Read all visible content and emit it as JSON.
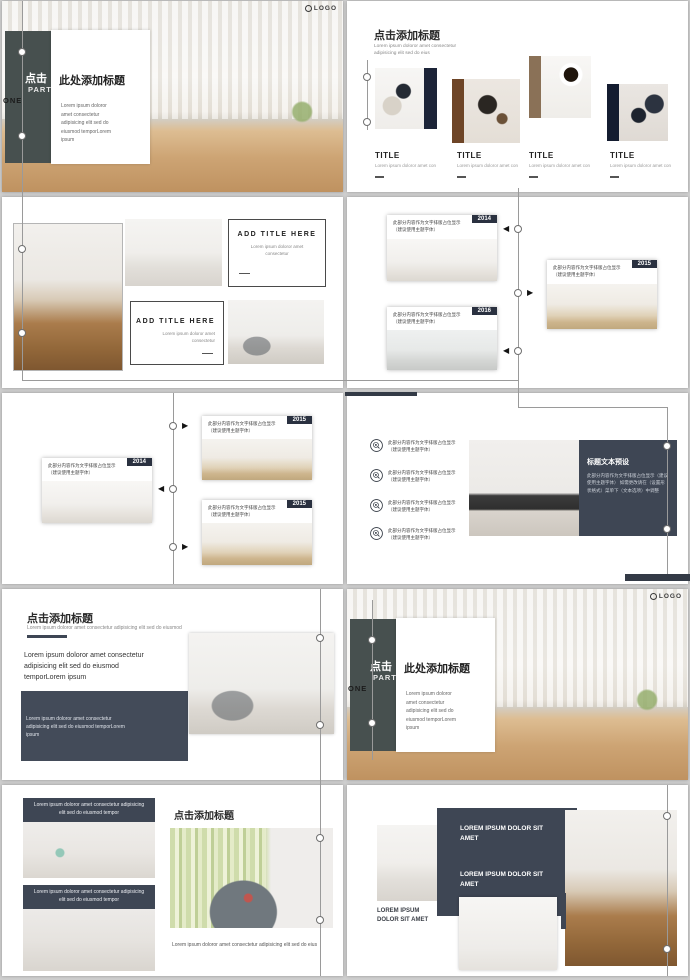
{
  "logo": {
    "text": "LOGO"
  },
  "colors": {
    "gap_background": "#cfcfcf",
    "accent_dark": "#3e4654",
    "cover_panel": "#47504f",
    "badge_navy": "#2a3140",
    "bar_navy": "#1c2438",
    "bar_brown": "#6e4527",
    "bar_tan": "#8a7157"
  },
  "cover": {
    "click": "点击",
    "part": "PART",
    "one": "ONE",
    "title": "此处添加标题",
    "body": "Lorem ipsum doloror amet consectetur adipisicing elit sed do eiusmod temporLorem ipsum"
  },
  "slide2": {
    "title": "点击添加标题",
    "subtitle": "Lorem ipsum doloror amet consectetur adipisicing elit sed do eius",
    "cards": [
      {
        "title": "TITLE",
        "desc": "Lorem ipsum doloror amet con"
      },
      {
        "title": "TITLE",
        "desc": "Lorem ipsum doloror amet con"
      },
      {
        "title": "TITLE",
        "desc": "Lorem ipsum doloror amet con"
      },
      {
        "title": "TITLE",
        "desc": "Lorem ipsum doloror amet con"
      }
    ]
  },
  "slide3": {
    "boxes": [
      {
        "title": "ADD TITLE HERE",
        "body": "Lorem ipsum doloror amet consectetur"
      },
      {
        "title": "ADD TITLE HERE",
        "body": "Lorem ipsum doloror amet consectetur"
      }
    ]
  },
  "timeline_placeholder": {
    "line1": "此部分内容作为文字排版占位显示",
    "line2": "（建议使用主题字体）"
  },
  "slide4": {
    "years": [
      "2014",
      "2016",
      "2015"
    ]
  },
  "slide5": {
    "years": [
      "2015",
      "2015",
      "2014"
    ]
  },
  "slide6": {
    "item_line1": "此部分内容作为文字排版占位显示",
    "item_line2": "（建议使用主题字体）",
    "panel_title": "标题文本预设",
    "panel_body": "此部分内容作为文字排版占位显示（建议使用主题字体） 如需更改请在（设置形状格式）菜单下（文本选项）中调整"
  },
  "slide7": {
    "title": "点击添加标题",
    "subtitle": "Lorem ipsum doloror amet consectetur adipisicing elit sed do eiusmod",
    "body": "Lorem ipsum doloror amet consectetur adipisicing elit sed do eiusmod temporLorem ipsum",
    "panel_body": "Lorem ipsum doloror amet consectetur adipisicing elit sed do eiusmod temporLorem ipsum"
  },
  "slide9": {
    "card_text": "Lorem ipsum doloror amet consectetur adipisicing elit sed do eiusmod tempor",
    "title": "点击添加标题",
    "caption": "Lorem ipsum doloror amet consectetur adipisicing elit sed do eius"
  },
  "slide10": {
    "label_left": "LOREM IPSUM DOLOR SIT AMET",
    "label_panel1": "LOREM IPSUM DOLOR SIT AMET",
    "label_panel2": "LOREM IPSUM DOLOR SIT AMET"
  }
}
